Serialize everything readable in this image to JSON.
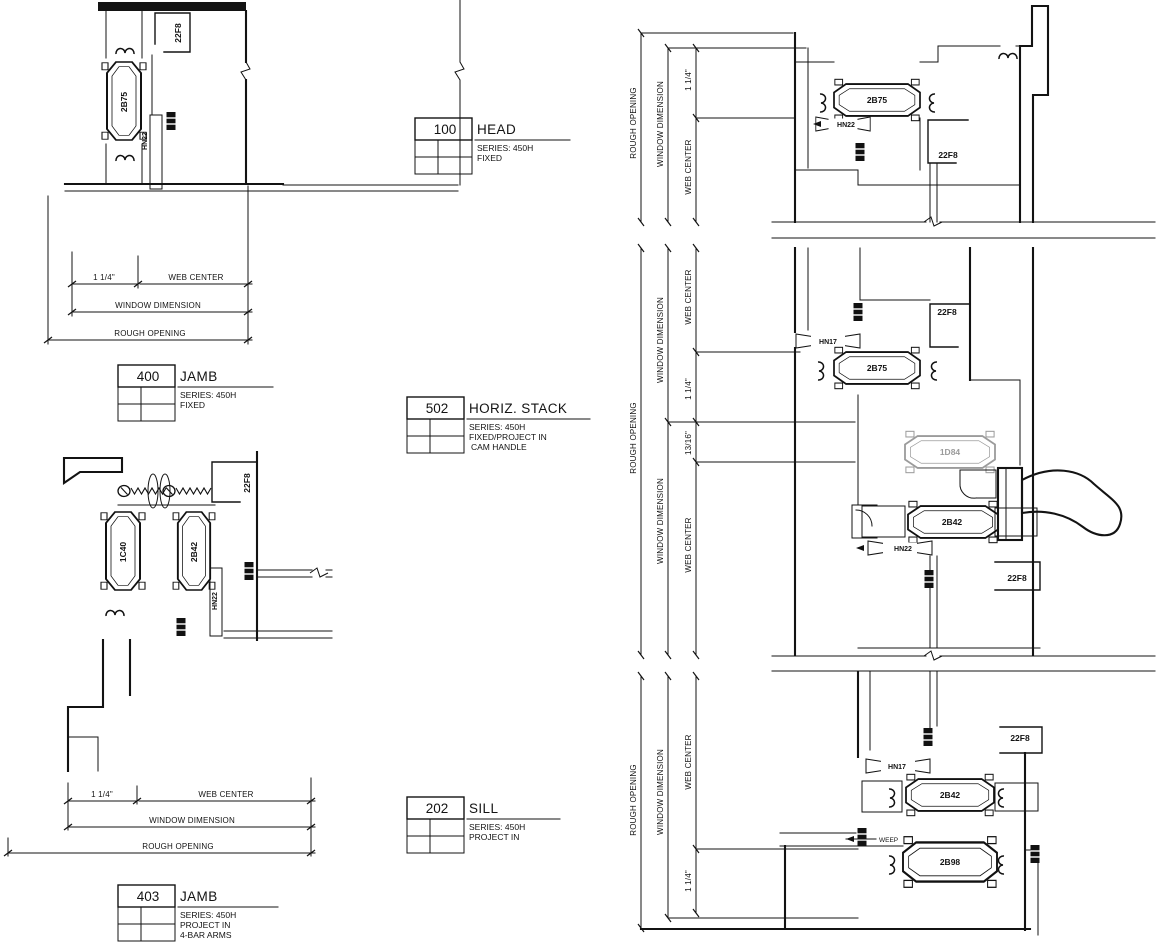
{
  "colors": {
    "ink": "#131313",
    "grey": "#9b9b9b",
    "paper": "#ffffff"
  },
  "blocks": {
    "head": {
      "number": "100",
      "title": "HEAD",
      "notes": [
        "SERIES: 450H",
        "FIXED"
      ]
    },
    "jamb_fixed": {
      "number": "400",
      "title": "JAMB",
      "notes": [
        "SERIES: 450H",
        "FIXED"
      ]
    },
    "horiz_stack": {
      "number": "502",
      "title": "HORIZ. STACK",
      "notes": [
        "SERIES: 450H",
        "FIXED/PROJECT IN",
        "CAM HANDLE"
      ]
    },
    "sill": {
      "number": "202",
      "title": "SILL",
      "notes": [
        "SERIES: 450H",
        "PROJECT IN"
      ]
    },
    "jamb_project": {
      "number": "403",
      "title": "JAMB",
      "notes": [
        "SERIES: 450H",
        "PROJECT IN",
        "4-BAR ARMS"
      ]
    }
  },
  "dims": {
    "rough_opening": "ROUGH OPENING",
    "window_dimension": "WINDOW DIMENSION",
    "web_center": "WEB CENTER",
    "inch_1_14": "1 1/4\"",
    "inch_13_16": "13/16\""
  },
  "parts": {
    "p2B75": "2B75",
    "p2B42": "2B42",
    "p2B98": "2B98",
    "p1C40": "1C40",
    "p1D84": "1D84",
    "p22F8": "22F8",
    "pHN22": "HN22",
    "pHN17": "HN17",
    "weep": "WEEP"
  }
}
